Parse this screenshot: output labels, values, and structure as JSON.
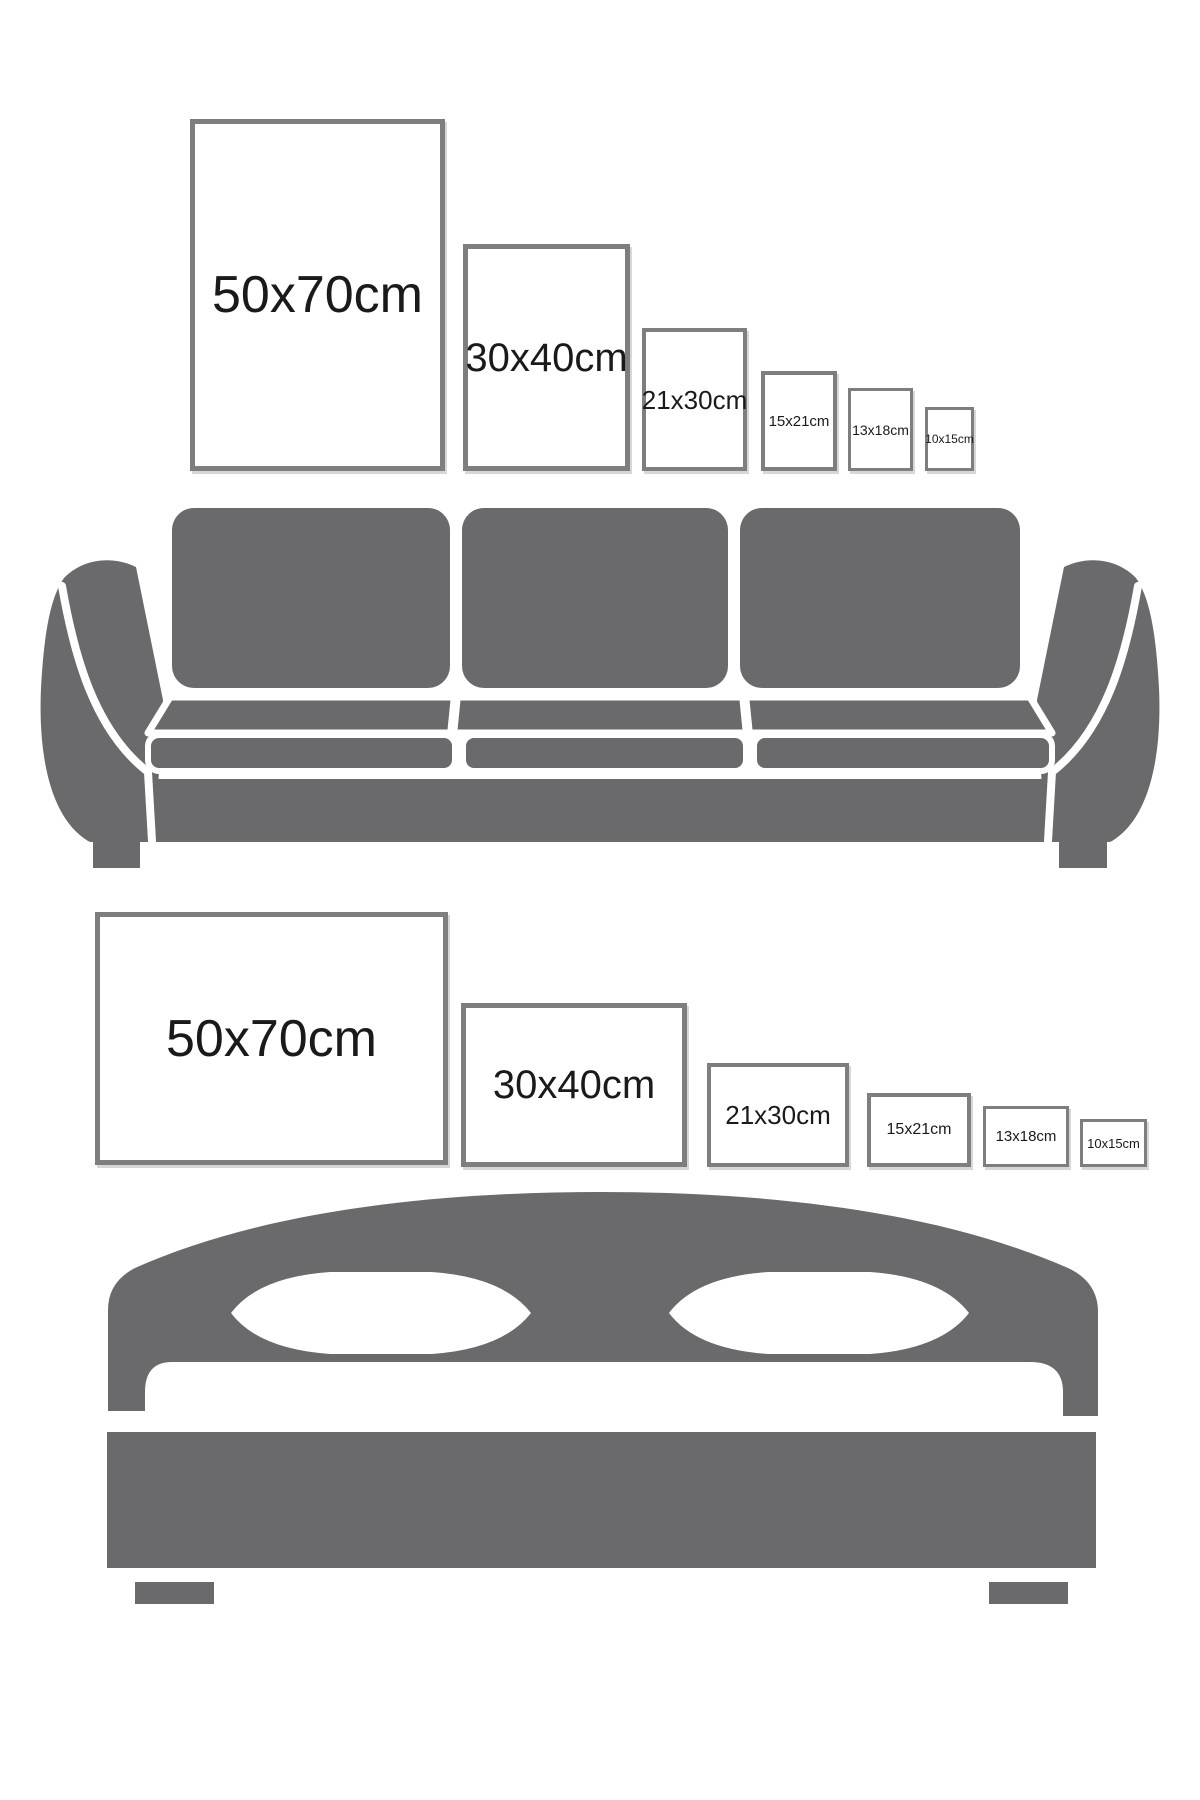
{
  "colors": {
    "furniture": "#6a6a6c",
    "frame_border": "#7c7e80",
    "label_text": "#1a1a1a",
    "background": "#ffffff"
  },
  "sections": [
    {
      "id": "sofa-wall",
      "furniture": "three-seat-sofa",
      "frame_orientation": "portrait",
      "frames": [
        {
          "label": "50x70cm",
          "w_cm": 50,
          "h_cm": 70
        },
        {
          "label": "30x40cm",
          "w_cm": 30,
          "h_cm": 40
        },
        {
          "label": "21x30cm",
          "w_cm": 21,
          "h_cm": 30
        },
        {
          "label": "15x21cm",
          "w_cm": 15,
          "h_cm": 21
        },
        {
          "label": "13x18cm",
          "w_cm": 13,
          "h_cm": 18
        },
        {
          "label": "10x15cm",
          "w_cm": 10,
          "h_cm": 15
        }
      ]
    },
    {
      "id": "bed-wall",
      "furniture": "double-bed",
      "frame_orientation": "landscape",
      "frames": [
        {
          "label": "50x70cm",
          "w_cm": 70,
          "h_cm": 50
        },
        {
          "label": "30x40cm",
          "w_cm": 40,
          "h_cm": 30
        },
        {
          "label": "21x30cm",
          "w_cm": 30,
          "h_cm": 21
        },
        {
          "label": "15x21cm",
          "w_cm": 21,
          "h_cm": 15
        },
        {
          "label": "13x18cm",
          "w_cm": 18,
          "h_cm": 13
        },
        {
          "label": "10x15cm",
          "w_cm": 15,
          "h_cm": 10
        }
      ]
    }
  ]
}
